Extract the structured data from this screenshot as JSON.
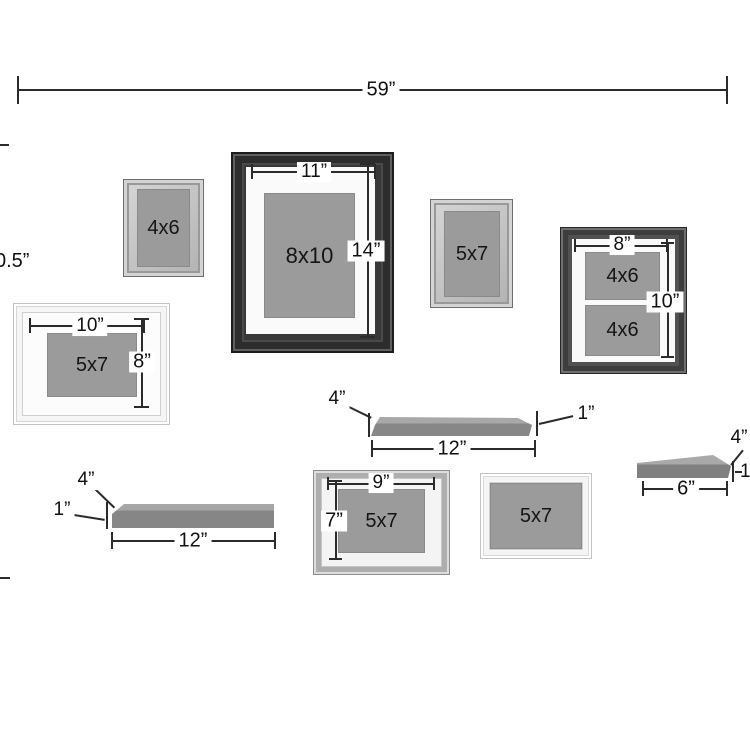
{
  "wall": {
    "overall_width": "59”",
    "overall_height_partial": "0.5”"
  },
  "frames": {
    "small_4x6": {
      "label": "4x6"
    },
    "large_8x10": {
      "label": "8x10",
      "w": "11”",
      "h": "14”"
    },
    "small_5x7": {
      "label": "5x7"
    },
    "double_4x6": {
      "label_top": "4x6",
      "label_bottom": "4x6",
      "w": "8”",
      "h": "10”"
    },
    "white_5x7_left": {
      "label": "5x7",
      "w": "10”",
      "h": "8”"
    },
    "gray_5x7_bottom": {
      "label": "5x7",
      "w": "9”",
      "h": "7”"
    },
    "white_5x7_bottom": {
      "label": "5x7"
    }
  },
  "shelves": {
    "middle": {
      "length": "12”",
      "depth": "4”",
      "thickness": "1”"
    },
    "bottom_left": {
      "length": "12”",
      "depth": "4”",
      "thickness": "1”"
    },
    "right": {
      "length": "6”",
      "depth": "4”",
      "thickness": "1”"
    }
  }
}
